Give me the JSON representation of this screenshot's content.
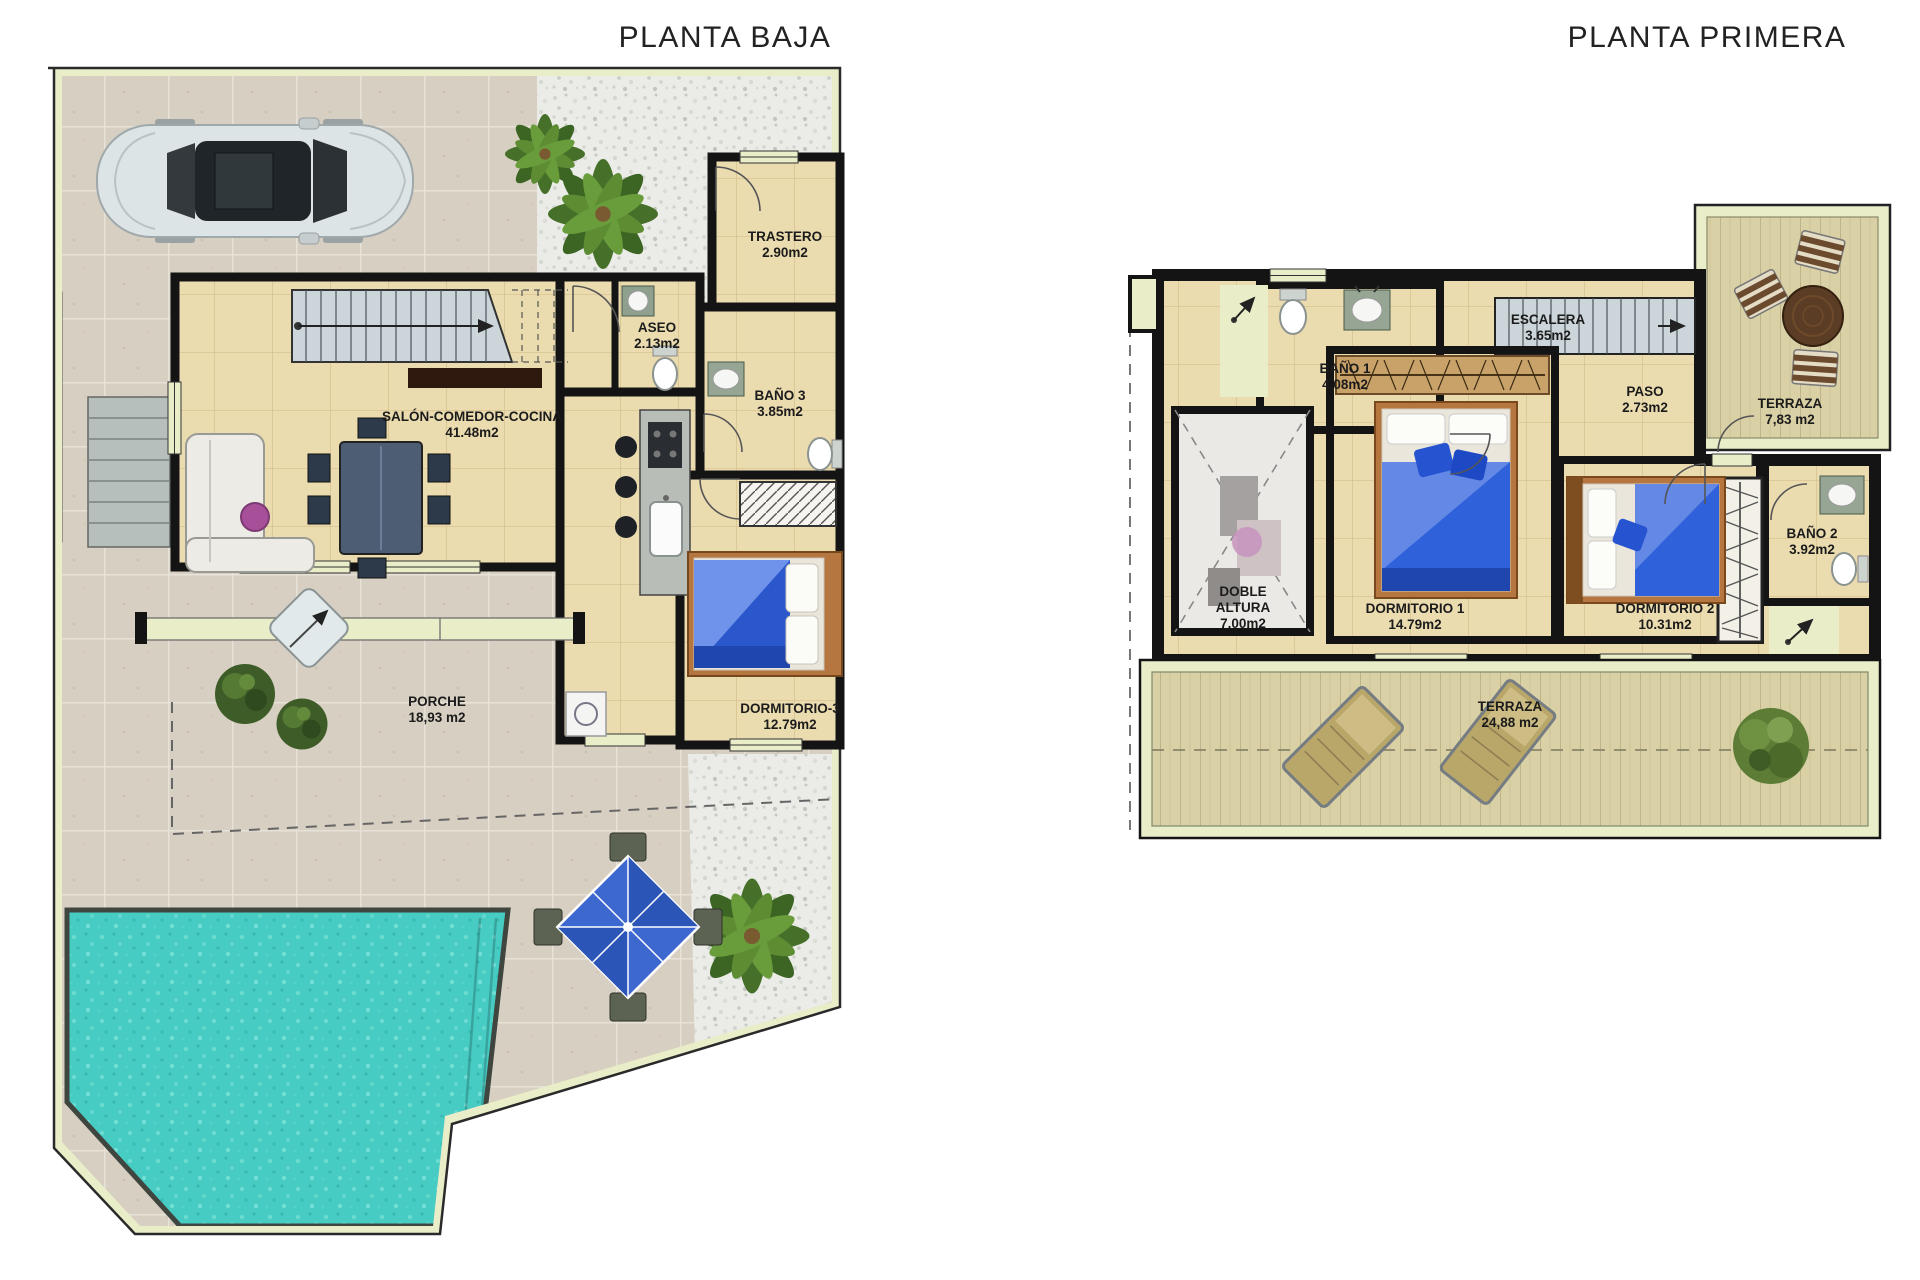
{
  "titles": {
    "left": "PLANTA BAJA",
    "right": "PLANTA PRIMERA"
  },
  "watermark": {
    "letter": "j",
    "label": "JJ PROPERTIES"
  },
  "planta_baja": {
    "rooms": [
      {
        "id": "trastero",
        "name": "TRASTERO",
        "area": "2.90m2"
      },
      {
        "id": "aseo",
        "name": "ASEO",
        "area": "2.13m2"
      },
      {
        "id": "bano3",
        "name": "BAÑO 3",
        "area": "3.85m2"
      },
      {
        "id": "salon",
        "name": "SALÓN-COMEDOR-COCINA",
        "area": "41.48m2"
      },
      {
        "id": "porche",
        "name": "PORCHE",
        "area": "18,93 m2"
      },
      {
        "id": "dormitorio3",
        "name": "DORMITORIO-3",
        "area": "12.79m2"
      }
    ]
  },
  "planta_primera": {
    "rooms": [
      {
        "id": "bano1",
        "name": "BAÑO 1",
        "area": "4.08m2"
      },
      {
        "id": "escalera",
        "name": "ESCALERA",
        "area": "3.65m2"
      },
      {
        "id": "paso",
        "name": "PASO",
        "area": "2.73m2"
      },
      {
        "id": "terraza-alta",
        "name": "TERRAZA",
        "area": "7,83 m2"
      },
      {
        "id": "doble-altura",
        "name": "DOBLE ALTURA",
        "area": "7.00m2"
      },
      {
        "id": "dormitorio1",
        "name": "DORMITORIO 1",
        "area": "14.79m2"
      },
      {
        "id": "dormitorio2",
        "name": "DORMITORIO 2",
        "area": "10.31m2"
      },
      {
        "id": "bano2",
        "name": "BAÑO 2",
        "area": "3.92m2"
      },
      {
        "id": "terraza-baja",
        "name": "TERRAZA",
        "area": "24,88 m2"
      }
    ]
  },
  "colors": {
    "pool": "#48cec6",
    "walls": "#141414",
    "boundary": "#e9edc8",
    "interior_floor": "#ebdcb0",
    "deck": "#d9d0a6",
    "gravel": "#ebece8",
    "tile": "#d7cfc1",
    "bed": "#2f62da"
  }
}
